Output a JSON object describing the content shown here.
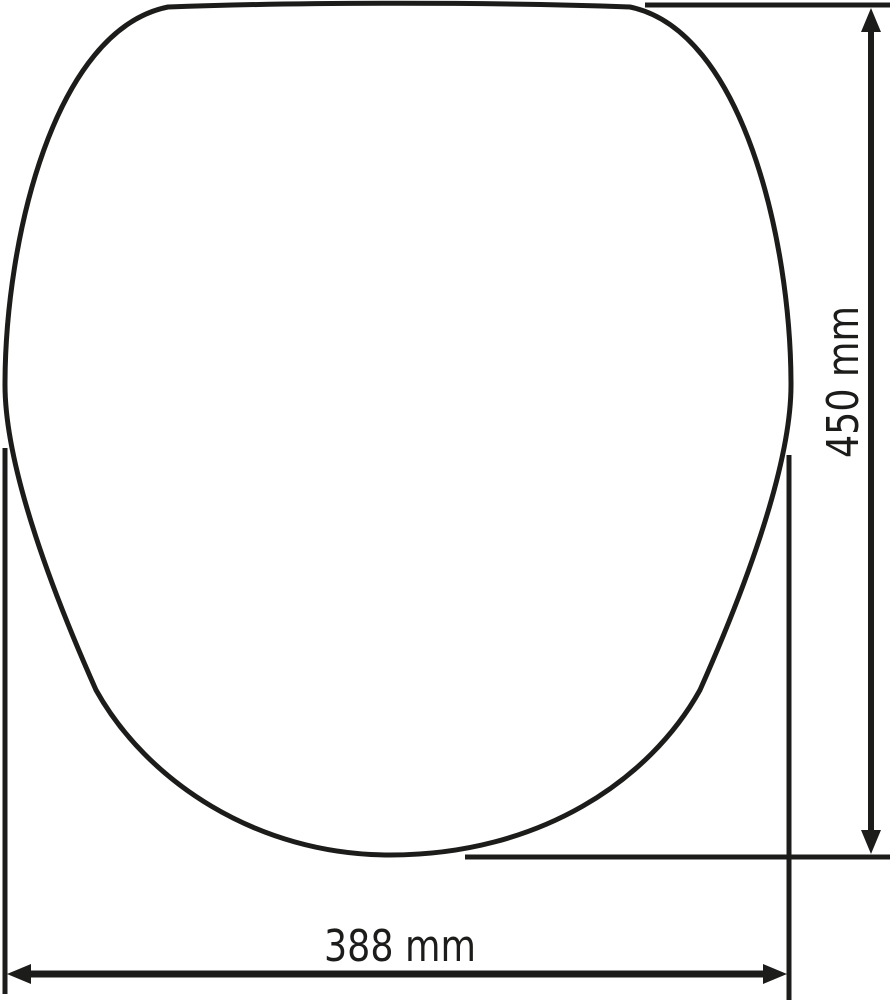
{
  "diagram": {
    "background_color": "#ffffff",
    "line_color": "#1c1c1a",
    "shape_name": "oval-lid-outline",
    "dimensions": {
      "height": {
        "label": "450 mm",
        "value": 450,
        "unit": "mm",
        "orientation": "vertical"
      },
      "width": {
        "label": "388 mm",
        "value": 388,
        "unit": "mm",
        "orientation": "horizontal"
      }
    }
  }
}
